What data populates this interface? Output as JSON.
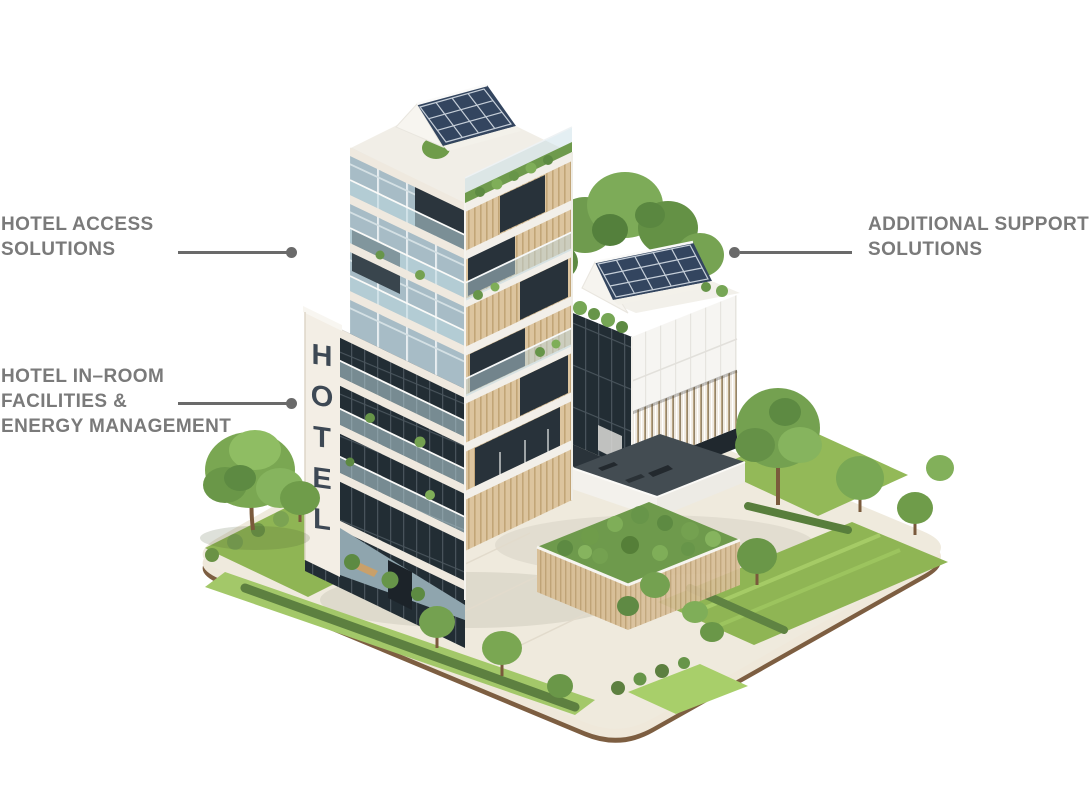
{
  "page": {
    "background_color": "#ffffff"
  },
  "labels": {
    "text_color": "#7a7a7a",
    "leader_line_color": "#6a6a6a",
    "access": {
      "line1": "HOTEL ACCESS",
      "line2": "SOLUTIONS"
    },
    "in_room": {
      "line1": "HOTEL IN–ROOM",
      "line2": "FACILITIES &",
      "line3": "ENERGY MANAGEMENT"
    },
    "support": {
      "line1": "ADDITIONAL SUPPORT",
      "line2": "SOLUTIONS"
    }
  },
  "illustration": {
    "sign_text": "HOTEL",
    "colors": {
      "sign_color": "#3d4854",
      "solar_panel": "#33455f",
      "solar_grid": "#c6cfd9",
      "roof_white": "#f2f0ea",
      "facade_white": "#f6f5f2",
      "wood": "#d8bf98",
      "glass_dark": "#232d34",
      "glass_light": "#a7bcc6",
      "grass": "#8fb554",
      "grass_light": "#a8cf6a",
      "hedge": "#5d8040",
      "tree_green": "#6f9c4a",
      "trunk": "#7a5a3c",
      "pavement": "#efeadd",
      "plot_side": "#efe8da",
      "plot_rim": "#7d5e41"
    }
  }
}
